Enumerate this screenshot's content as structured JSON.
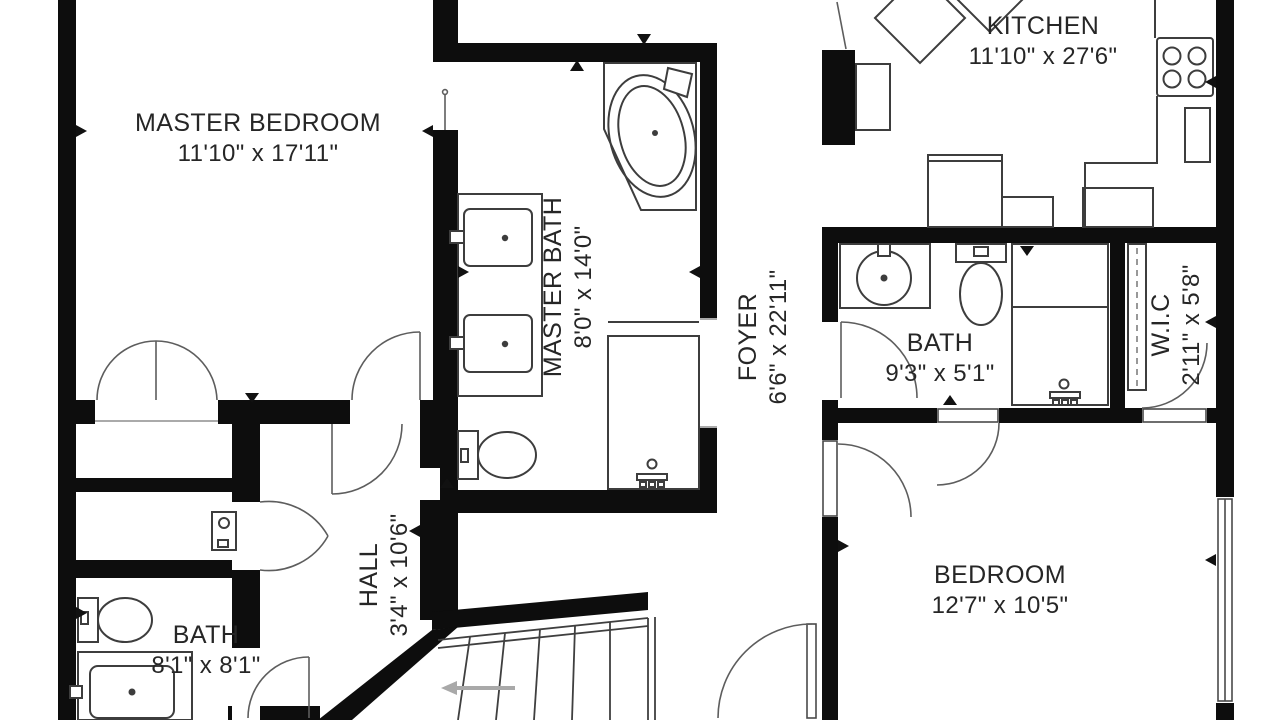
{
  "plan": {
    "type": "residential floor plan",
    "colors": {
      "wall": "#0d0d0d",
      "fixture_line": "#3d3d3d",
      "door_arc": "#5d5d5d",
      "background": "#ffffff",
      "stairs_arrow": "#a9a9a9",
      "text": "#262626"
    }
  },
  "rooms": [
    {
      "id": "master-bedroom",
      "label": "MASTER BEDROOM",
      "dims": "11'10\" x 17'11\""
    },
    {
      "id": "master-bath",
      "label": "MASTER BATH",
      "dims": "8'0\" x 14'0\""
    },
    {
      "id": "kitchen",
      "label": "KITCHEN",
      "dims": "11'10\" x 27'6\""
    },
    {
      "id": "foyer",
      "label": "FOYER",
      "dims": "6'6\" x 22'11\""
    },
    {
      "id": "bath",
      "label": "BATH",
      "dims": "9'3\" x 5'1\""
    },
    {
      "id": "wic",
      "label": "W.I.C",
      "dims": "2'11\" x 5'8\""
    },
    {
      "id": "bedroom",
      "label": "BEDROOM",
      "dims": "12'7\" x 10'5\""
    },
    {
      "id": "hall",
      "label": "HALL",
      "dims": "3'4\" x 10'6\""
    },
    {
      "id": "bath-2",
      "label": "BATH",
      "dims": "8'1\" x 8'1\""
    }
  ]
}
